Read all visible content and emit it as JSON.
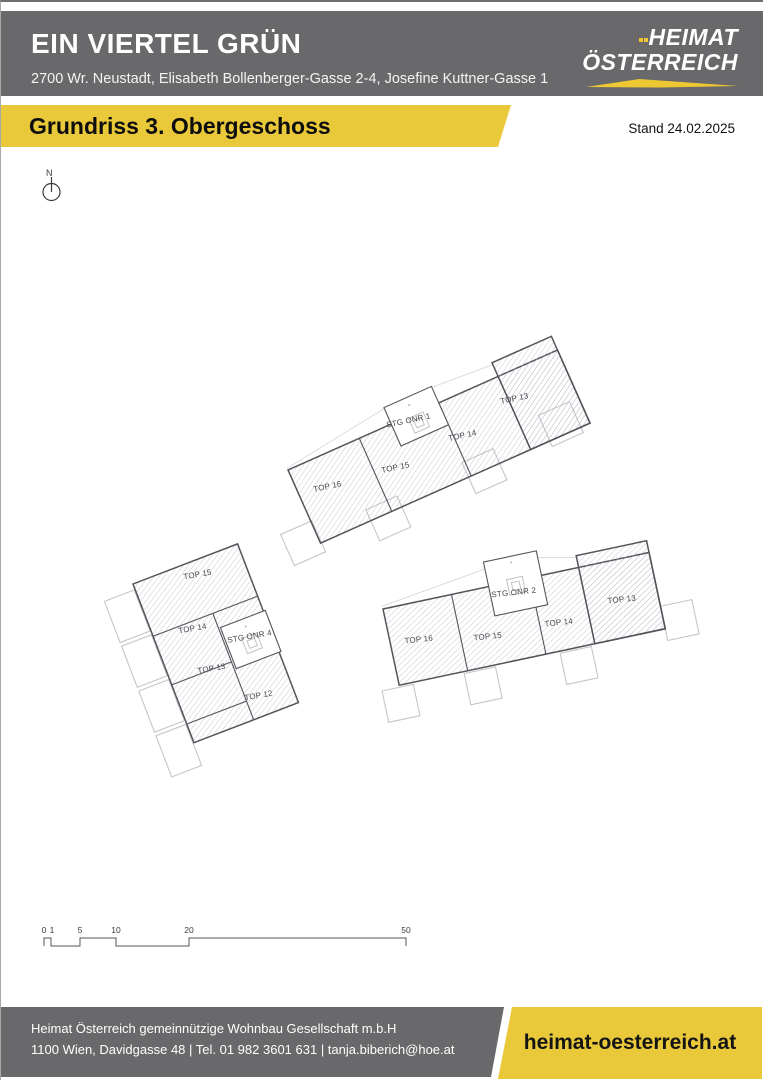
{
  "header": {
    "title": "EIN VIERTEL GRÜN",
    "address": "2700 Wr. Neustadt, Elisabeth Bollenberger-Gasse 2-4, Josefine Kuttner-Gasse 1",
    "logo": {
      "line1": "HEIMAT",
      "line2": "ÖSTERREICH"
    }
  },
  "title_bar": {
    "label": "Grundriss 3. Obergeschoss",
    "stand": "Stand 24.02.2025"
  },
  "plan": {
    "north_label": "N",
    "buildings": [
      {
        "id": "building-stg-1",
        "stairwell": "STG ONR 1",
        "units": [
          "TOP 16",
          "TOP 15",
          "TOP 14",
          "TOP 13"
        ]
      },
      {
        "id": "building-stg-4",
        "stairwell": "STG ONR 4",
        "units": [
          "TOP 15",
          "TOP 14",
          "TOP 13",
          "TOP 12"
        ]
      },
      {
        "id": "building-stg-2",
        "stairwell": "STG ONR 2",
        "units": [
          "TOP 16",
          "TOP 15",
          "TOP 14",
          "TOP 13"
        ]
      }
    ],
    "scale_bar": {
      "labels": [
        "0",
        "1",
        "5",
        "10",
        "20",
        "50"
      ]
    }
  },
  "footer": {
    "company": "Heimat Österreich gemeinnützige Wohnbau Gesellschaft m.b.H",
    "contact": "1100 Wien, Davidgasse 48 | Tel. 01 982 3601 631 | tanja.biberich@hoe.at",
    "website": "heimat-oesterreich.at"
  },
  "colors": {
    "accent_yellow": "#e9c93a",
    "band_gray": "#69686b",
    "wall_gray": "#54545a",
    "hatch_gray": "#b9bdc6"
  }
}
